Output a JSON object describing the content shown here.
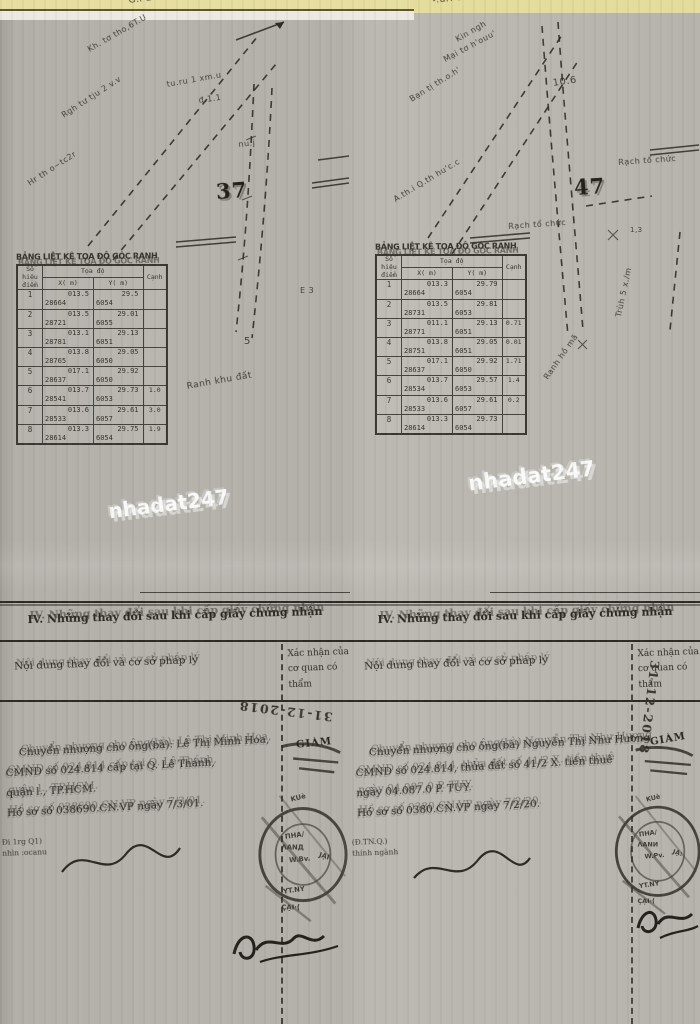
{
  "watermark": {
    "text": "nhadat247"
  },
  "pages": [
    {
      "sketch": {
        "plot_number": "37",
        "labels": [
          {
            "t": "G.i LUHUTD sv +-",
            "x": 128,
            "y": -4,
            "r": -7,
            "fs": 9
          },
          {
            "t": "Kh. tơ tho,6T.U",
            "x": 86,
            "y": 46,
            "r": -30,
            "fs": 8
          },
          {
            "t": "tu.ru 1 xm.u",
            "x": 166,
            "y": 80,
            "r": -10,
            "fs": 8
          },
          {
            "t": "đ.1.1",
            "x": 198,
            "y": 96,
            "r": -8,
            "fs": 8
          },
          {
            "t": "Rgh tư tju 2 v.v",
            "x": 60,
            "y": 112,
            "r": -33,
            "fs": 8
          },
          {
            "t": "nu.j",
            "x": 238,
            "y": 140,
            "r": -6,
            "fs": 8
          },
          {
            "t": "Hr th o~tc2r",
            "x": 26,
            "y": 180,
            "r": -33,
            "fs": 8
          },
          {
            "t": "E 3",
            "x": 300,
            "y": 286,
            "r": 0,
            "fs": 8
          },
          {
            "t": "5",
            "x": 244,
            "y": 336,
            "r": 0,
            "fs": 10
          },
          {
            "t": "Ranh khu đất",
            "x": 186,
            "y": 382,
            "r": -10,
            "fs": 9
          }
        ]
      },
      "table": {
        "title": "BẢNG LIỆT KÊ TỌA ĐỘ GÓC RANH",
        "col_point": "Số hiệu điểm",
        "col_coord": "Tọa độ",
        "col_x": "X( m)",
        "col_y": "Y( m)",
        "col_edge": "Cạnh",
        "rows": [
          {
            "n": "1",
            "x1": "013.5",
            "x2": "28664",
            "y1": "29.5",
            "y2": "6054",
            "c": ""
          },
          {
            "n": "2",
            "x1": "013.5",
            "x2": "28721",
            "y1": "29.01",
            "y2": "6055",
            "c": ""
          },
          {
            "n": "3",
            "x1": "013.1",
            "x2": "28781",
            "y1": "29.13",
            "y2": "6051",
            "c": ""
          },
          {
            "n": "4",
            "x1": "013.8",
            "x2": "28765",
            "y1": "29.05",
            "y2": "6050",
            "c": ""
          },
          {
            "n": "5",
            "x1": "017.1",
            "x2": "28637",
            "y1": "29.92",
            "y2": "6050",
            "c": ""
          },
          {
            "n": "6",
            "x1": "013.7",
            "x2": "28541",
            "y1": "29.73",
            "y2": "6053",
            "c": "1.0"
          },
          {
            "n": "7",
            "x1": "013.6",
            "x2": "28533",
            "y1": "29.61",
            "y2": "6057",
            "c": "3.0"
          },
          {
            "n": "8",
            "x1": "013.3",
            "x2": "28614",
            "y1": "29.75",
            "y2": "6054",
            "c": "1.9"
          }
        ]
      },
      "section4": {
        "title": "IV. Những thay đổi sau khi cấp giấy chứng nhận",
        "col_content": "Nội dung thay đổi và cơ sở pháp lý",
        "col_confirm1": "Xác nhận của",
        "col_confirm2": "cơ quan có thẩm",
        "date": "31-12-2018",
        "giam": "GIÁM",
        "lines": [
          "Chuyển nhượng cho ông(bà): Lê Thị Minh Hoa,",
          "CMND số 024.814 cấp tại Q. Lê Thánh,",
          "quận l., TP.HCM.",
          "Hồ sơ số 038690.CN.VP ngày 7/3/01."
        ],
        "small1": "Đi 1rg Q1)",
        "small2": "nhìn :ocanu"
      }
    },
    {
      "sketch": {
        "plot_number": "47",
        "labels": [
          {
            "t": "-.uri eduhgri-",
            "x": 82,
            "y": -4,
            "r": -6,
            "fs": 9
          },
          {
            "t": "Kin ngh",
            "x": 104,
            "y": 36,
            "r": -30,
            "fs": 8
          },
          {
            "t": "Mại tơ h'ouu'",
            "x": 92,
            "y": 56,
            "r": -28,
            "fs": 8
          },
          {
            "t": "10.6",
            "x": 202,
            "y": 78,
            "r": -8,
            "fs": 10
          },
          {
            "t": "Bạn tị th.o.h'",
            "x": 58,
            "y": 96,
            "r": -32,
            "fs": 8
          },
          {
            "t": "Rạch tổ chức",
            "x": 268,
            "y": 158,
            "r": -4,
            "fs": 8
          },
          {
            "t": "A.th.i Q.th hu'c.c",
            "x": 42,
            "y": 196,
            "r": -31,
            "fs": 8
          },
          {
            "t": "Rạch tổ chức",
            "x": 158,
            "y": 222,
            "r": -4,
            "fs": 8
          },
          {
            "t": "1,3",
            "x": 280,
            "y": 226,
            "r": 0,
            "fs": 7
          },
          {
            "t": "Trùh 5 x./m",
            "x": 264,
            "y": 316,
            "r": -78,
            "fs": 8
          },
          {
            "t": "Ranh hồ mã",
            "x": 192,
            "y": 376,
            "r": -55,
            "fs": 8
          }
        ]
      },
      "table": {
        "title": "BẢNG LIỆT KÊ TỌA ĐỘ GÓC RANH",
        "col_point": "Số hiệu điểm",
        "col_coord": "Tọa độ",
        "col_x": "X( m)",
        "col_y": "Y( m)",
        "col_edge": "Cạnh",
        "rows": [
          {
            "n": "1",
            "x1": "013.3",
            "x2": "28664",
            "y1": "29.79",
            "y2": "6054",
            "c": ""
          },
          {
            "n": "2",
            "x1": "013.5",
            "x2": "28731",
            "y1": "29.81",
            "y2": "6053",
            "c": ""
          },
          {
            "n": "3",
            "x1": "011.1",
            "x2": "28771",
            "y1": "29.13",
            "y2": "6051",
            "c": "0.71"
          },
          {
            "n": "4",
            "x1": "013.8",
            "x2": "28751",
            "y1": "29.05",
            "y2": "6051",
            "c": "0.01"
          },
          {
            "n": "5",
            "x1": "017.1",
            "x2": "28637",
            "y1": "29.92",
            "y2": "6050",
            "c": "1.71"
          },
          {
            "n": "6",
            "x1": "013.7",
            "x2": "28534",
            "y1": "29.57",
            "y2": "6053",
            "c": "1.4"
          },
          {
            "n": "7",
            "x1": "013.6",
            "x2": "28533",
            "y1": "29.61",
            "y2": "6057",
            "c": "0.2"
          },
          {
            "n": "8",
            "x1": "013.3",
            "x2": "28614",
            "y1": "29.73",
            "y2": "6054",
            "c": ""
          }
        ]
      },
      "section4": {
        "title": "IV. Những thay đổi sau khi cấp giấy chứng nhận",
        "col_content": "Nội dung thay đổi và cơ sở pháp lý",
        "col_confirm1": "Xác nhận của",
        "col_confirm2": "cơ quan có thẩm",
        "date": "31-12-2018",
        "giam": "GIÁM",
        "lines": [
          "Chuyển nhượng cho ông(bà) Nguyễn Thị Như Hương",
          "CMND số 024.814, thửa đất số 41/2 X. tiền thuê",
          "ngày 04.087.0 P. TUY.",
          "Hồ sơ số 0380.CN.VP ngày 7/2/20."
        ],
        "small1": "(Đ.TN.Q.)",
        "small2": "thính ngành"
      }
    }
  ]
}
